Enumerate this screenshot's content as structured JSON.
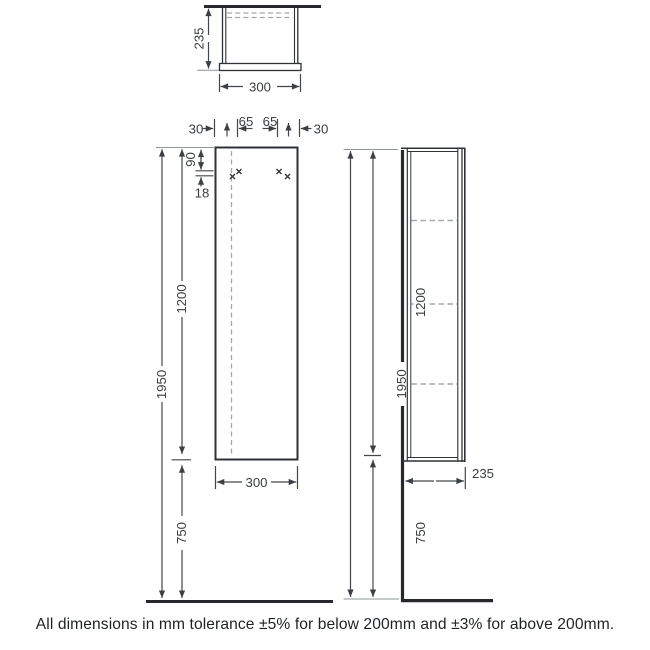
{
  "note": "All dimensions in mm tolerance ±5% for below 200mm and ±3% for above 200mm.",
  "views": {
    "top": {
      "depth": "235",
      "width": "300"
    },
    "front": {
      "edge_offset_left": "30",
      "hole_spacing_left": "65",
      "hole_spacing_right": "65",
      "edge_offset_right": "30",
      "hole_from_top": "90",
      "hole_row_gap": "18",
      "cabinet_height": "1200",
      "mounting_height": "1950",
      "width": "300",
      "floor_clearance": "750"
    },
    "side": {
      "mounting_height": "1950",
      "cabinet_height": "1200",
      "floor_clearance": "750",
      "depth": "235"
    }
  },
  "colors": {
    "heavy_line": "#26282b",
    "cabinet_line": "#2f3236",
    "dimension_line": "#43474c",
    "extension_line": "#8f969b",
    "dashed_line": "#a3a9ae",
    "label_text": "#3a3e42",
    "note_text": "#1f2225",
    "background": "#ffffff"
  }
}
